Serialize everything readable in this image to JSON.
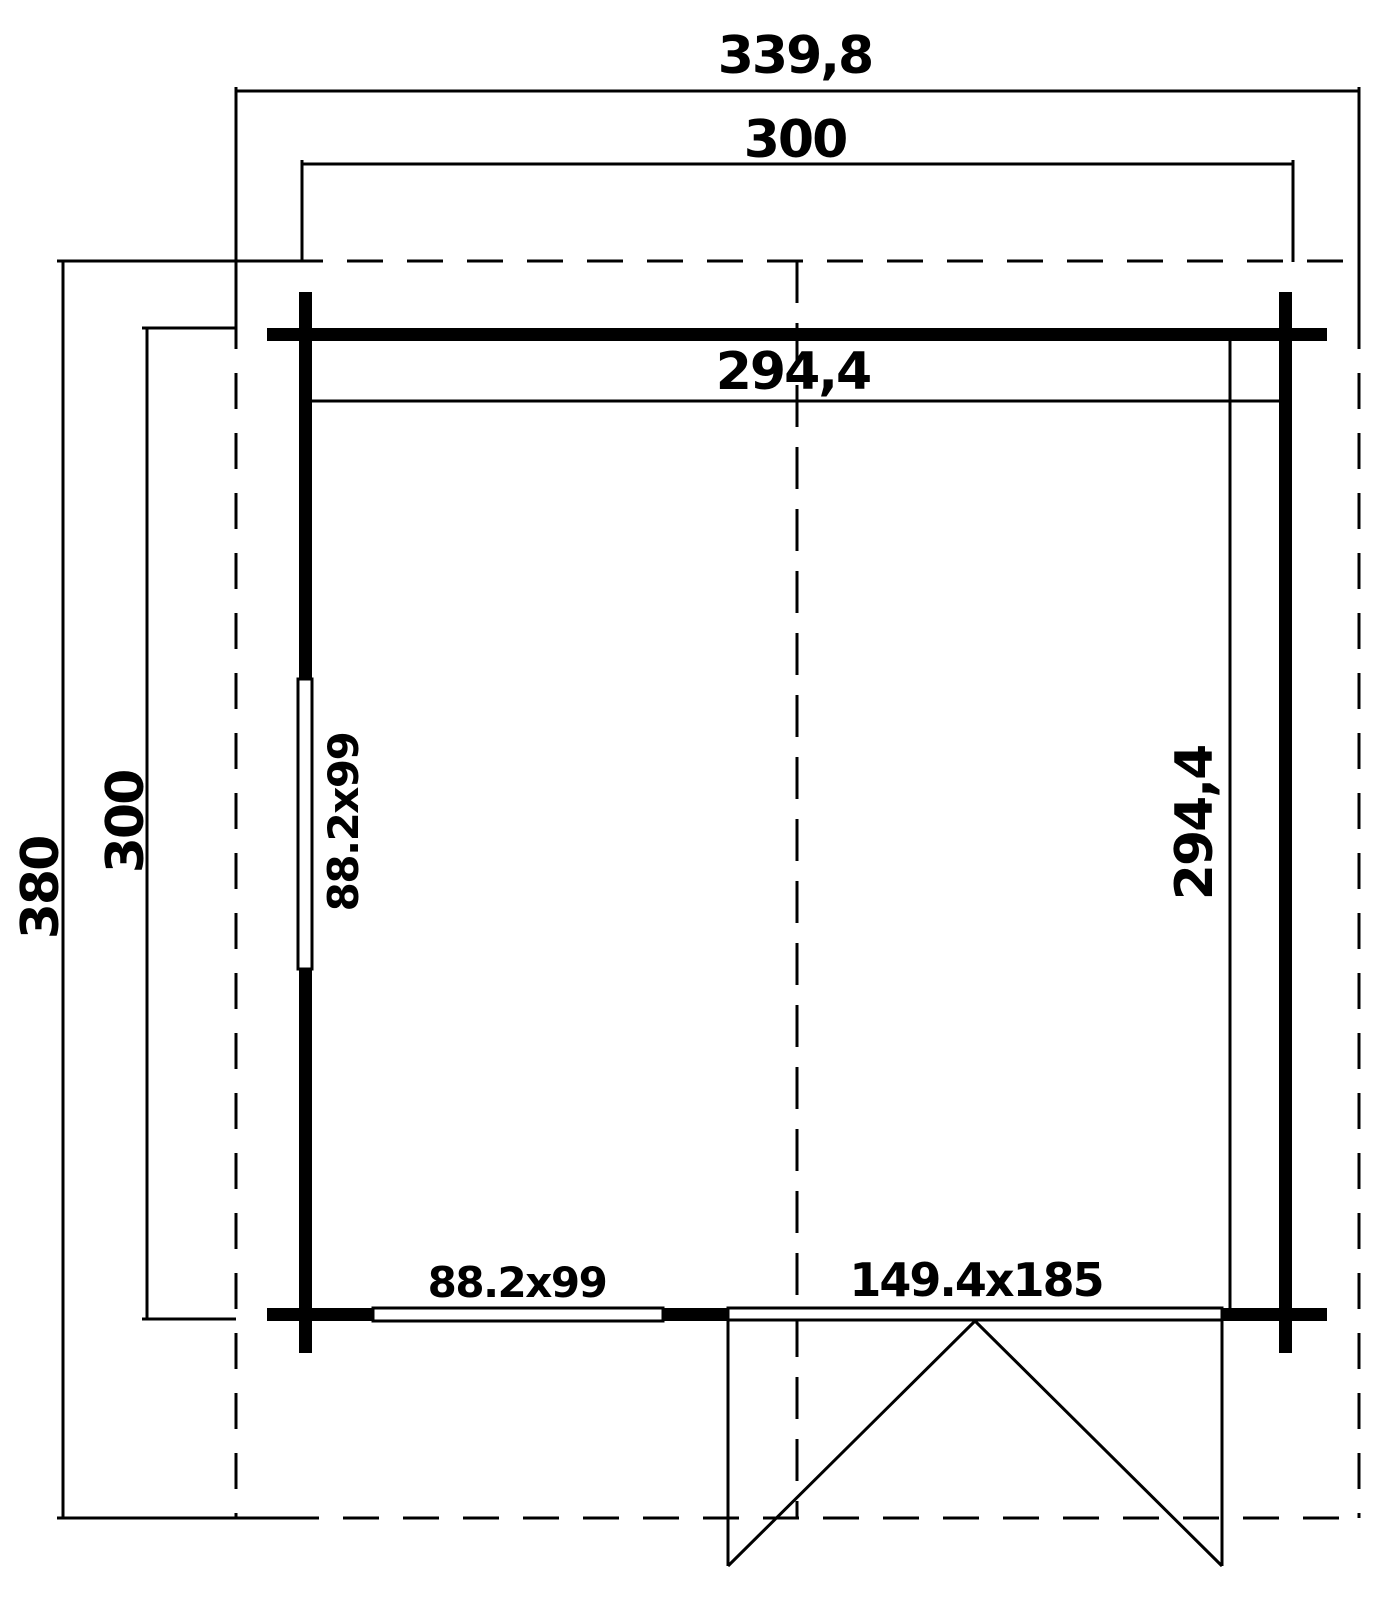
{
  "drawing": {
    "type": "garden-house floor plan",
    "colors": {
      "ink": "#000000",
      "paper": "#ffffff"
    },
    "dimensions": {
      "roof_width": "339,8",
      "wall_width": "300",
      "interior_width": "294,4",
      "roof_depth": "380",
      "wall_depth": "300",
      "interior_depth": "294,4"
    },
    "openings": {
      "side_window": "88.2x99",
      "front_window": "88.2x99",
      "door": "149.4x185"
    }
  }
}
